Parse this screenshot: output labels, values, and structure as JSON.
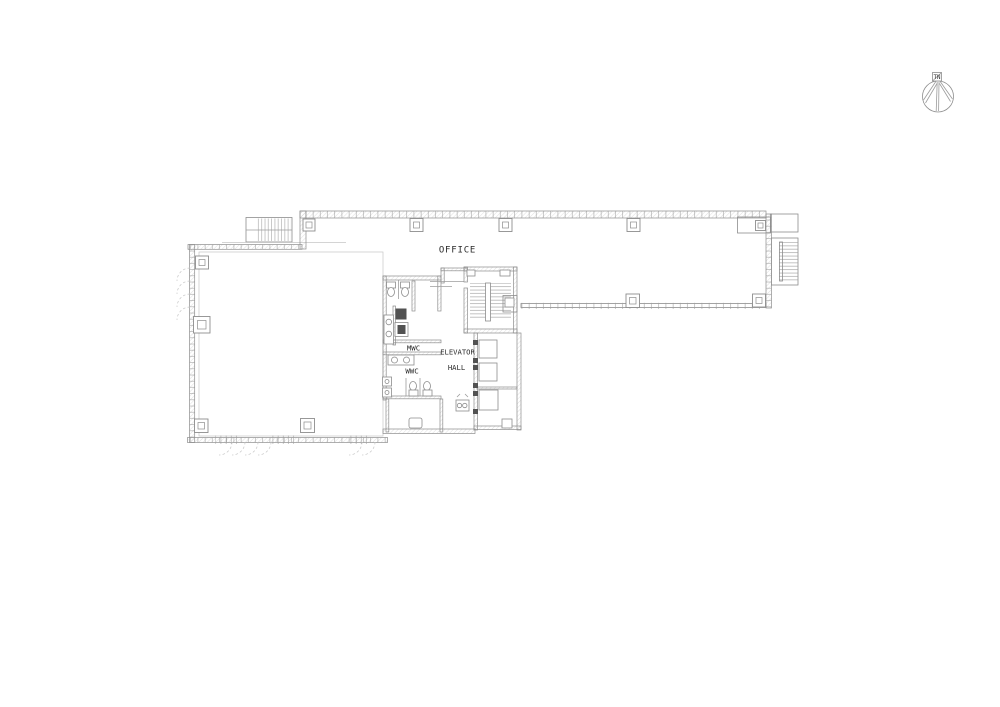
{
  "labels": {
    "office": "OFFICE",
    "elevator_line1": "ELEVATOR",
    "elevator_line2": "HALL",
    "mwc": "MWC",
    "wwc": "WWC",
    "north": "TN"
  },
  "rooms": [
    {
      "name": "office-wing",
      "label": "OFFICE"
    },
    {
      "name": "elevator-hall",
      "label": "ELEVATOR HALL"
    },
    {
      "name": "mens-wc",
      "label": "MWC"
    },
    {
      "name": "womens-wc",
      "label": "WWC"
    }
  ],
  "colors": {
    "background": "#ffffff",
    "line": "#9c9c9c",
    "line_light": "#c6c6c6",
    "wall_stroke": "#8d8d8d",
    "wall_fill": "#efefef",
    "dark_fill": "#525252",
    "text": "#2b2b2b"
  }
}
